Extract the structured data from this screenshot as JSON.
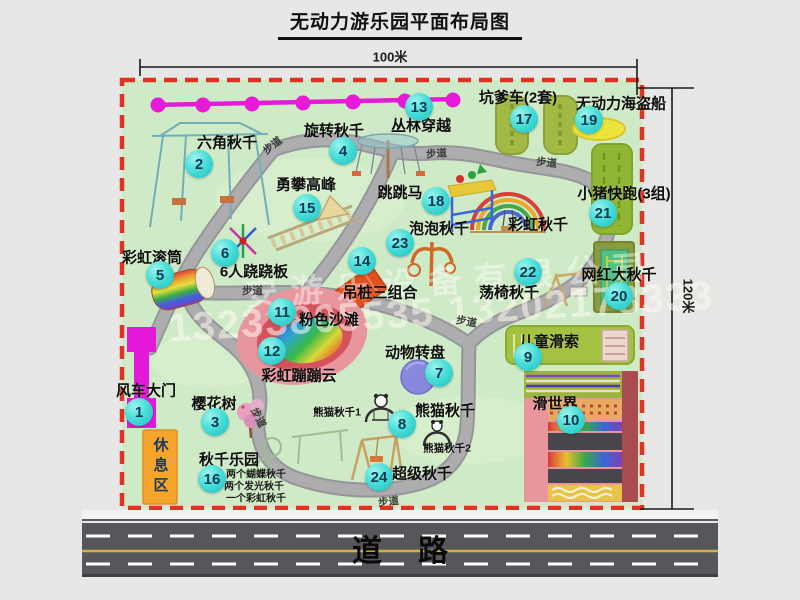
{
  "title": "无动力游乐园平面布局图",
  "dimensions": {
    "width": "100米",
    "height": "120米"
  },
  "road": {
    "label": "道路"
  },
  "watermark": {
    "company": "安游乐设备有限公司",
    "phone": "13233805535 13202178333"
  },
  "map": {
    "walkway_label": "步道",
    "items": [
      {
        "num": "1",
        "label": "风车大门"
      },
      {
        "num": "2",
        "label": "六角秋千"
      },
      {
        "num": "3",
        "label": "樱花树"
      },
      {
        "num": "4",
        "label": "旋转秋千"
      },
      {
        "num": "5",
        "label": "彩虹滚筒"
      },
      {
        "num": "6",
        "label": "6人跷跷板"
      },
      {
        "num": "7",
        "label": "动物转盘"
      },
      {
        "num": "8",
        "label": "熊猫秋千"
      },
      {
        "num": "9",
        "label": "儿童滑索"
      },
      {
        "num": "10",
        "label": "滑世界"
      },
      {
        "num": "11",
        "label": "粉色沙滩"
      },
      {
        "num": "12",
        "label": "彩虹蹦蹦云"
      },
      {
        "num": "13",
        "label": "丛林穿越"
      },
      {
        "num": "14",
        "label": "吊桩三组合"
      },
      {
        "num": "15",
        "label": "勇攀高峰"
      },
      {
        "num": "16",
        "label": "秋千乐园"
      },
      {
        "num": "17",
        "label": "坑爹车(2套)"
      },
      {
        "num": "18",
        "label": "跳跳马"
      },
      {
        "num": "19",
        "label": "无动力海盗船"
      },
      {
        "num": "20",
        "label": "网红大秋千"
      },
      {
        "num": "21",
        "label": "小猪快跑(3组)"
      },
      {
        "num": "22",
        "label": "荡椅秋千"
      },
      {
        "num": "23",
        "label": "泡泡秋千"
      },
      {
        "num": "24",
        "label": "超级秋千"
      }
    ],
    "extra": {
      "rainbow_swing": "彩虹秋千",
      "rest_area": "休息区",
      "panda_swing_1": "熊猫秋千1",
      "panda_swing_2": "熊猫秋千2",
      "swing_note_1": "两个蝴蝶秋千",
      "swing_note_2": "两个发光秋千",
      "swing_note_3": "一个彩虹秋千"
    }
  }
}
